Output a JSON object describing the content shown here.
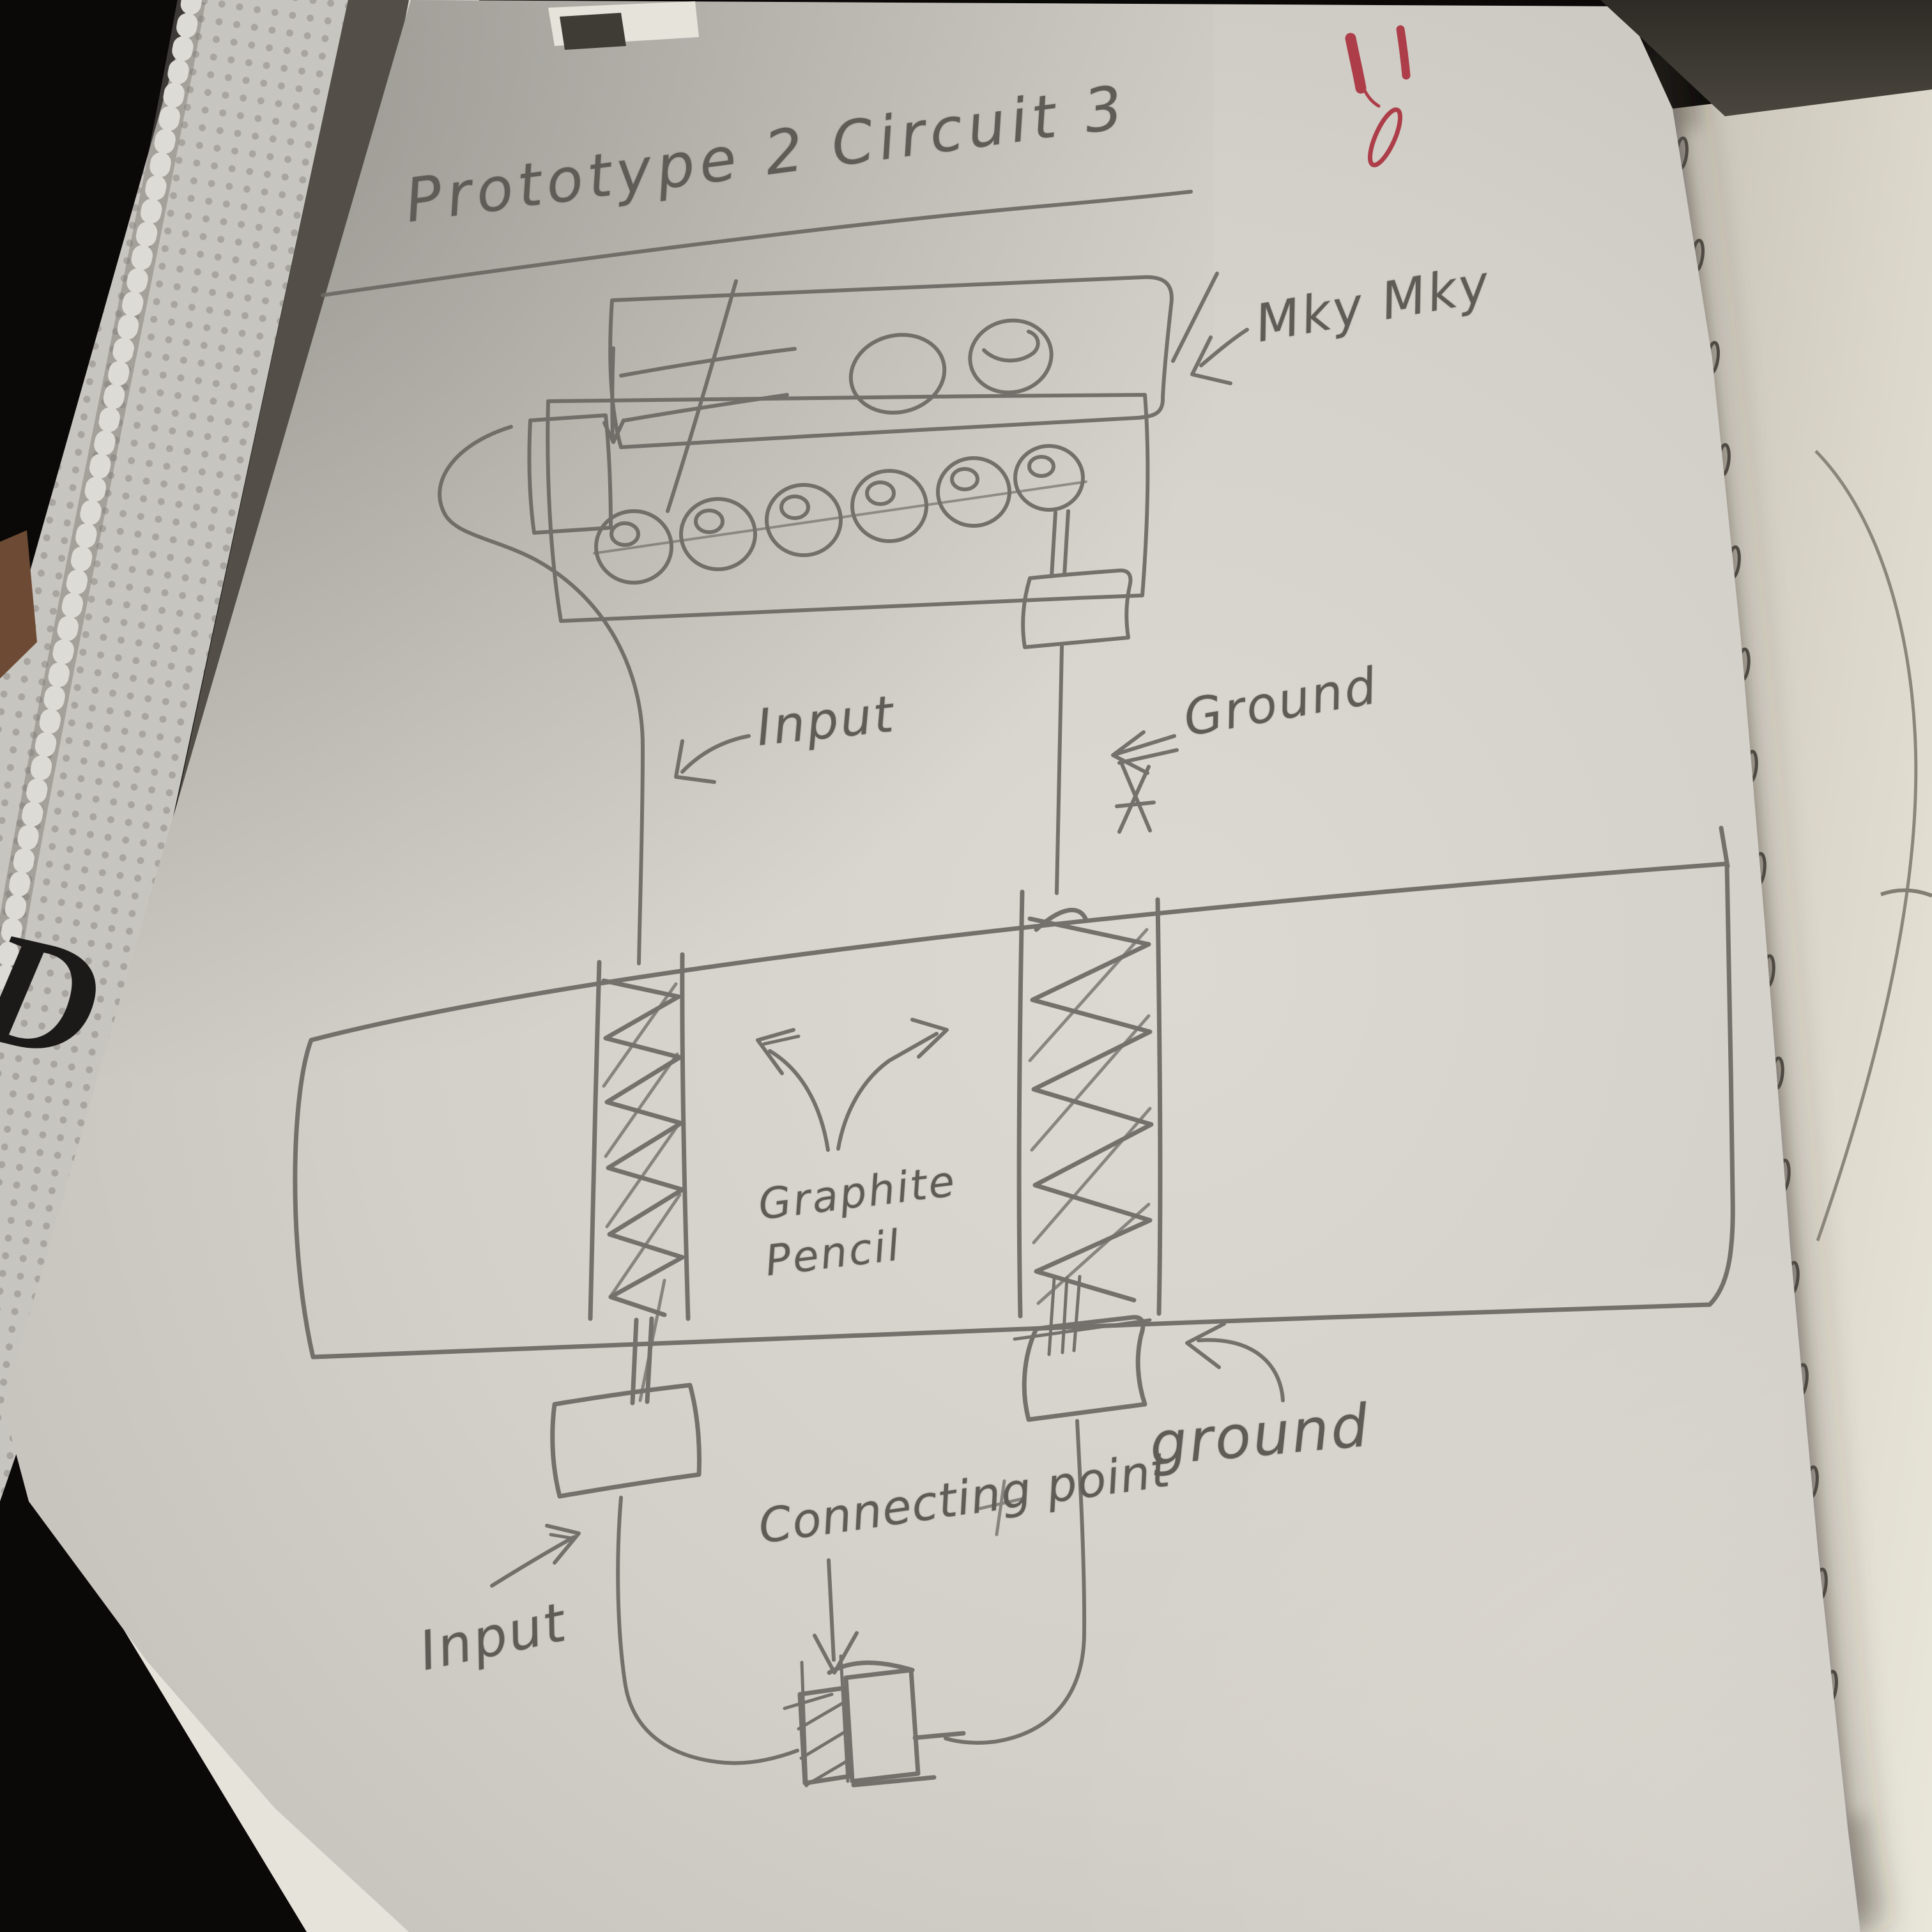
{
  "photo": {
    "book_cover_letter": "D",
    "colors": {
      "background": "#0a0908",
      "paper": "#d2cfc8",
      "right_page": "#ded9cd",
      "pencil": "#6b6864",
      "red_marks": "#ad3e49"
    }
  },
  "sketch": {
    "title": "Prototype 2 Circuit 3",
    "labels": {
      "board": "Mky Mky",
      "input_top": "Input",
      "ground_top": "Ground",
      "graphite_pencil": "Graphite Pencil",
      "connecting_point": "Connecting point",
      "ground_bottom": "ground",
      "input_bottom": "Input"
    }
  }
}
